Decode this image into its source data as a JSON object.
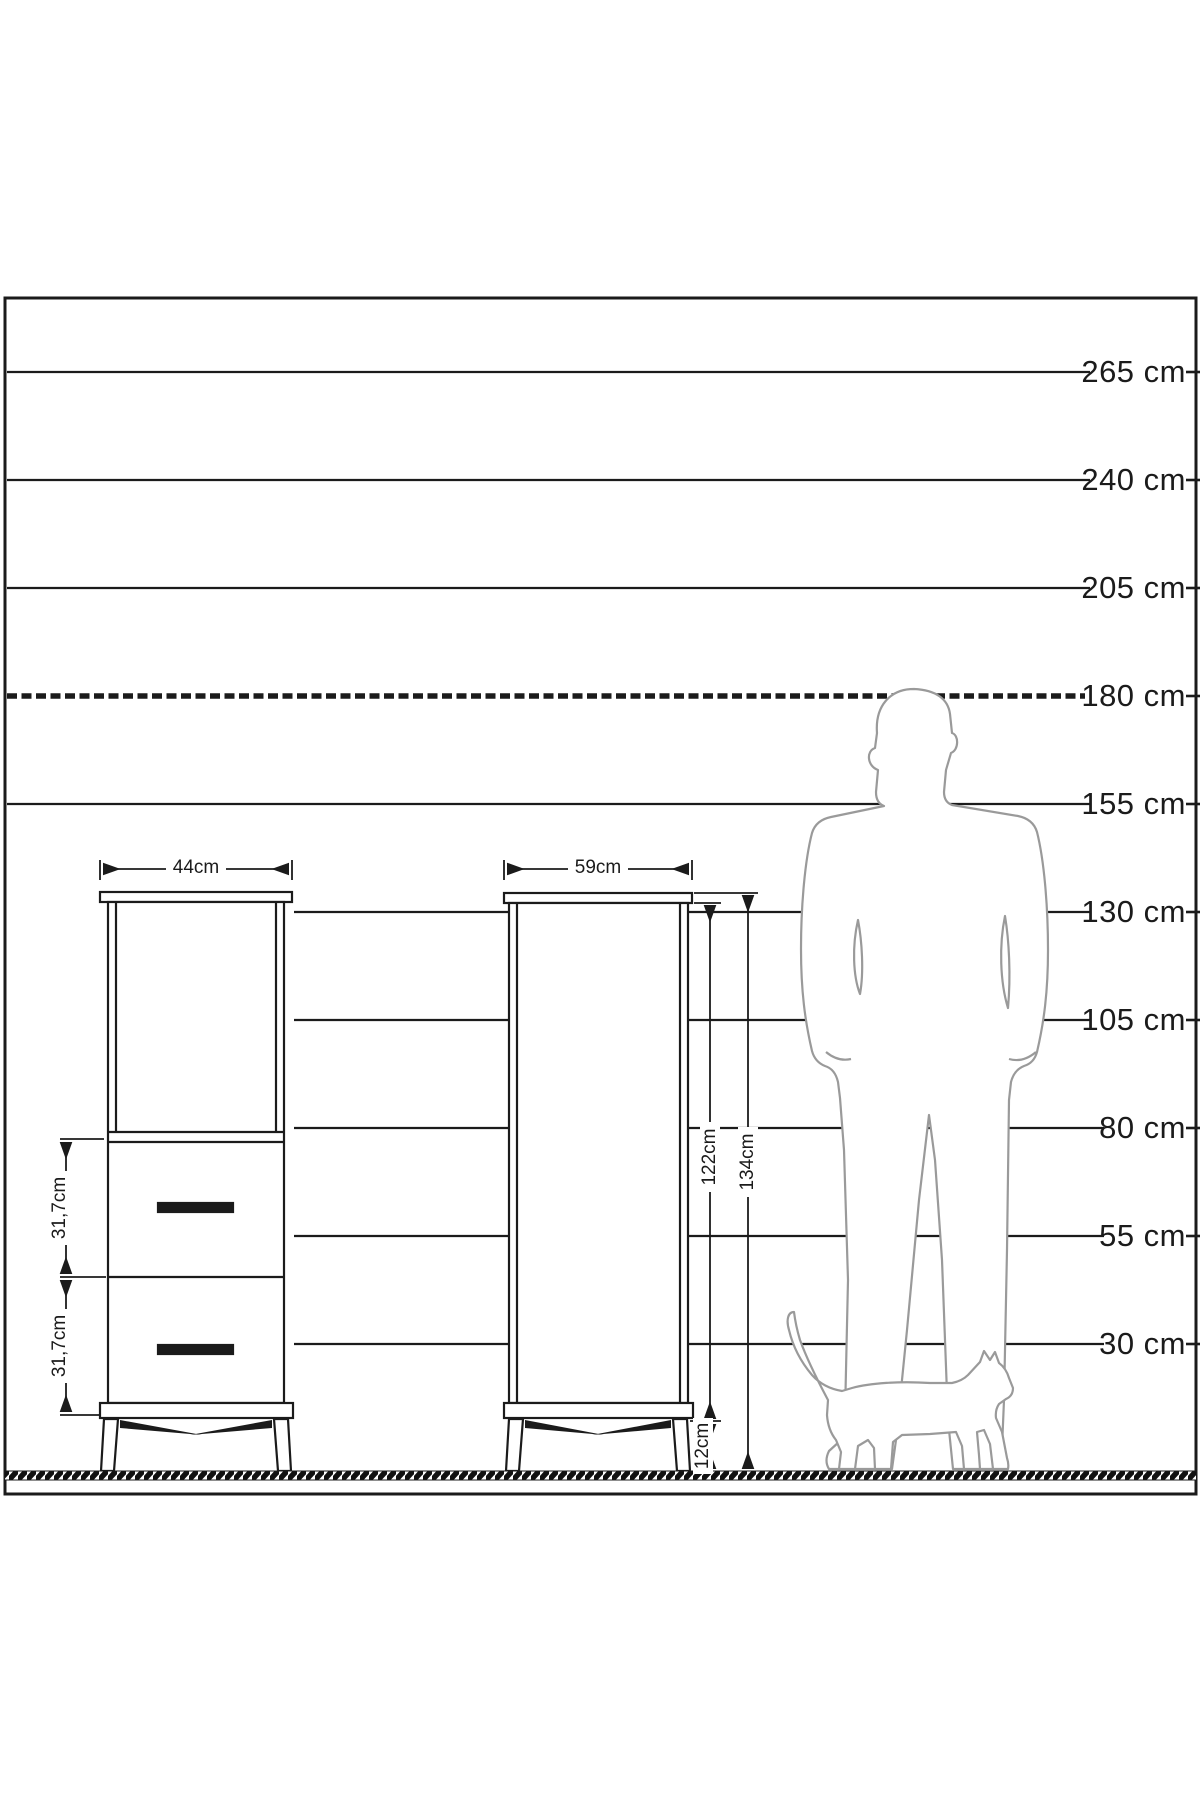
{
  "diagram_title": "furniture-height-scale-diagram",
  "unit": "cm",
  "scale": {
    "labels": [
      {
        "label": "265 cm"
      },
      {
        "label": "240 cm"
      },
      {
        "label": "205 cm"
      },
      {
        "label": "180 cm"
      },
      {
        "label": "155 cm"
      },
      {
        "label": "130 cm"
      },
      {
        "label": "105 cm"
      },
      {
        "label": "80 cm"
      },
      {
        "label": "55 cm"
      },
      {
        "label": "30 cm"
      }
    ]
  },
  "cabinets": {
    "left": {
      "width_label": "44cm",
      "drawer_top_height_label": "31,7cm",
      "drawer_bottom_height_label": "31,7cm"
    },
    "right": {
      "width_label": "59cm",
      "body_height_label": "122cm",
      "total_height_label": "134cm",
      "leg_height_label": "12cm"
    }
  },
  "figures": {
    "man": "man-silhouette",
    "cat": "cat-silhouette"
  },
  "colors": {
    "line": "#1b1b1b",
    "silhouette": "#9a9a9a",
    "background": "#ffffff"
  }
}
